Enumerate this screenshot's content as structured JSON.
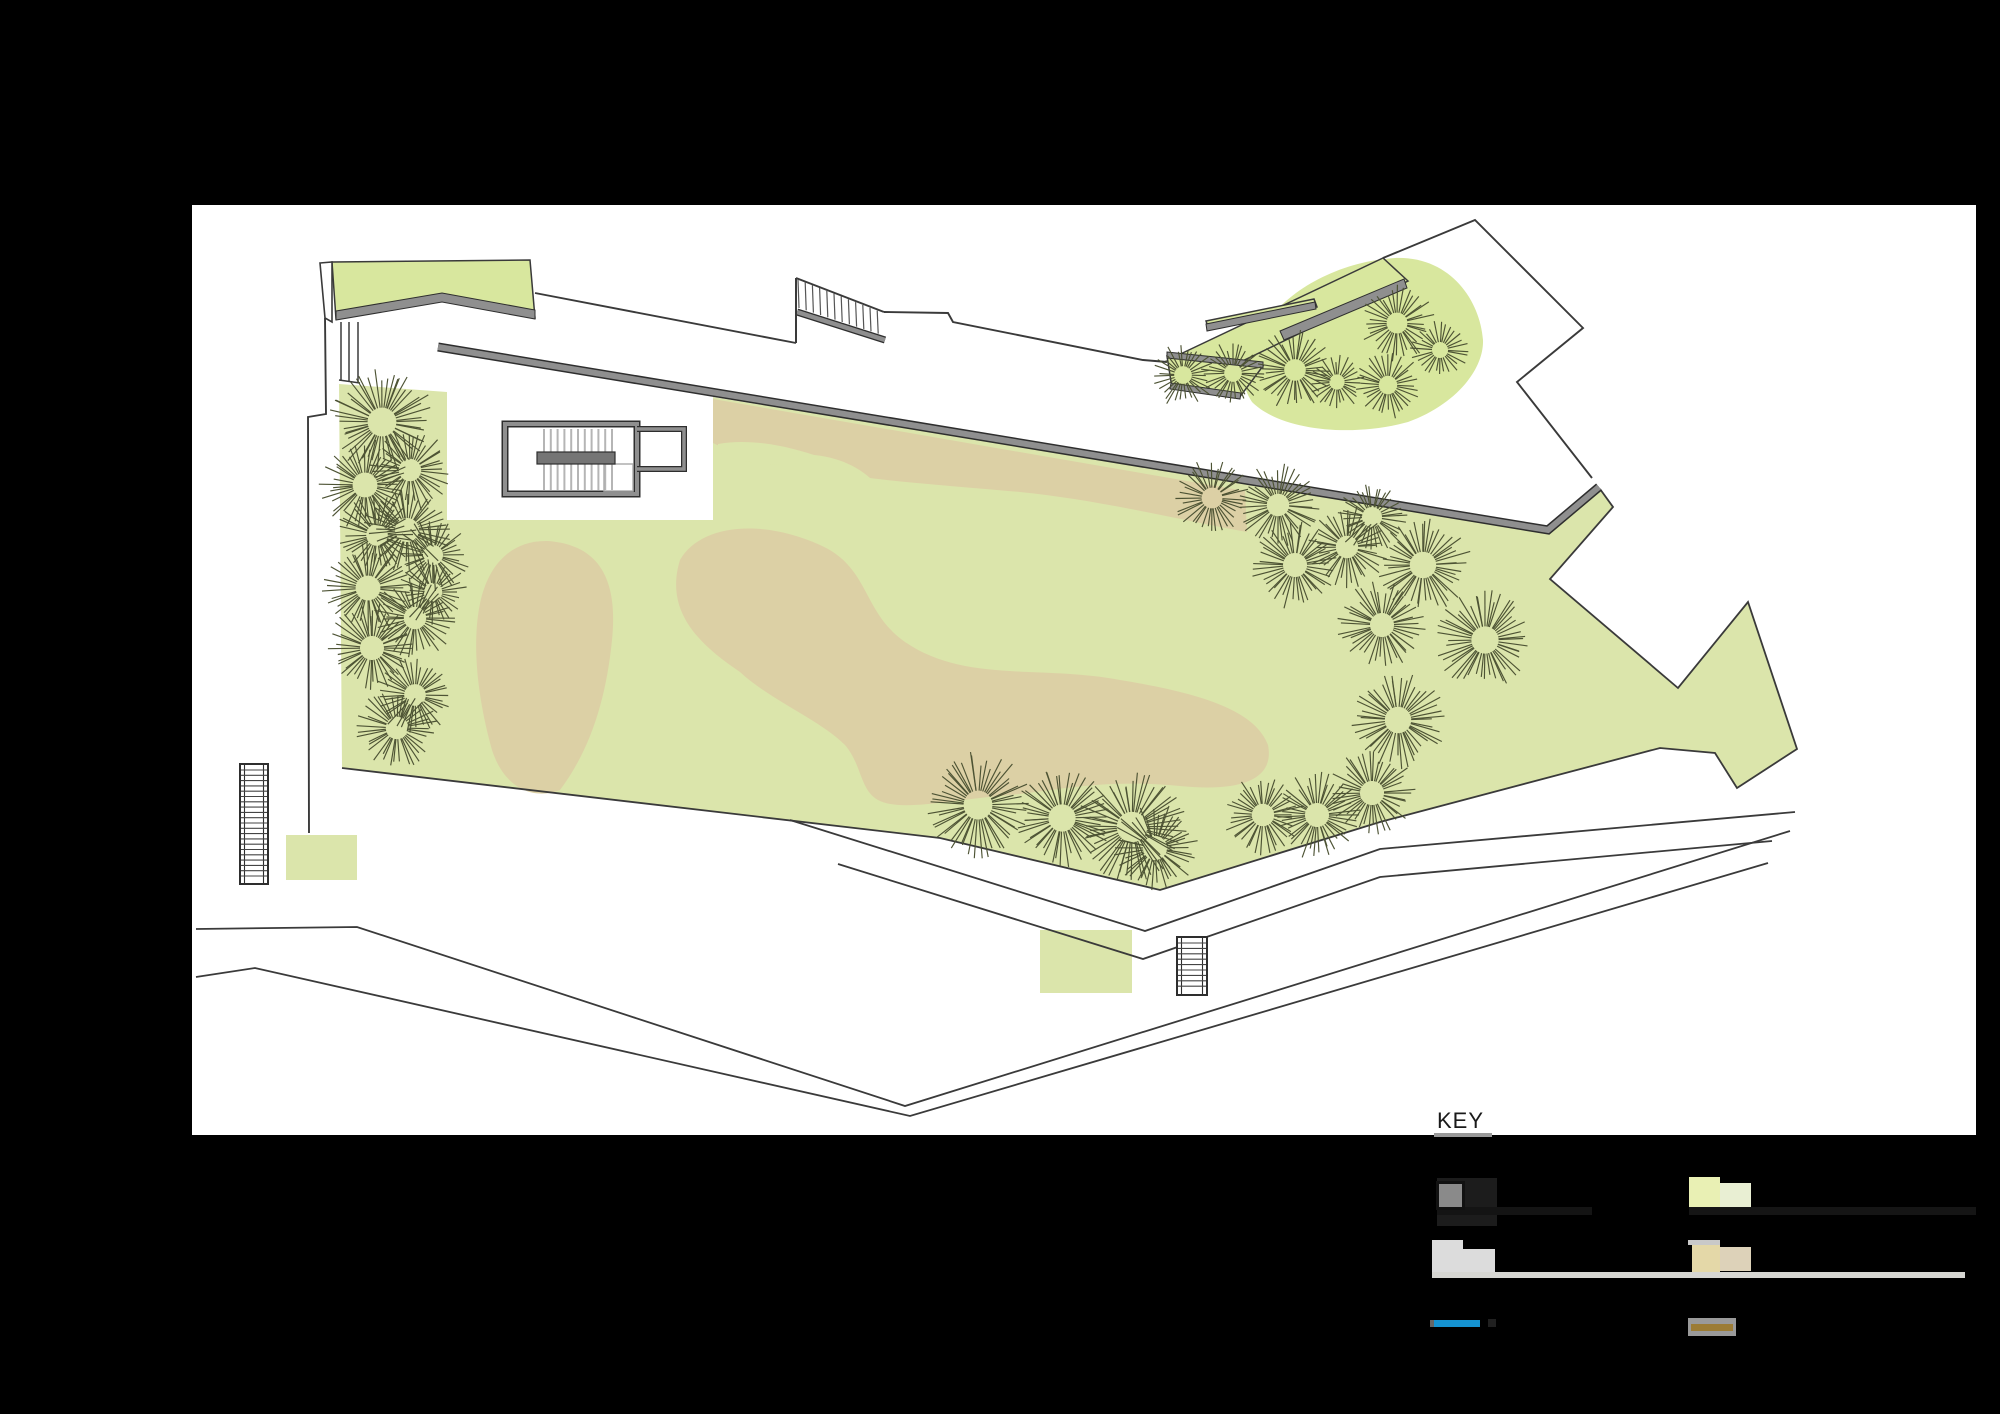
{
  "key": {
    "title": "KEY"
  },
  "legend": {
    "swatches": {
      "sw1": "#8a8a8a",
      "sw1_shadow": "#1c1c1c",
      "sw1_strip": "#141414",
      "sw2": "#e9f0b4",
      "sw2b": "#e9efd3",
      "sw2_strip": "#151515",
      "sw3": "#dcdcdc",
      "sw3b": "#dcdcdc",
      "strip_long": "#d6d6d2",
      "sw4": "#e4d8a8",
      "sw4b": "#ddd2b9",
      "sw4_sliver": "#c9c9c9",
      "sw5": "#1593d2",
      "sw5_tip": "#666666",
      "sw5_dot": "#202020",
      "sw6_bg": "#9a9a9a",
      "sw6": "#9c7c35"
    }
  },
  "plan": {
    "canvas": {
      "x": 192,
      "y": 205,
      "w": 1784,
      "h": 930,
      "fill": "#ffffff"
    },
    "colors": {
      "lawn": "#dbe5ab",
      "green2": "#d8e79e",
      "tan": "#dcd0a5",
      "wall": "#8f8f8f",
      "wallEdge": "#2e2e2e",
      "line": "#3a3a3a",
      "tree": "#4d5334",
      "tread": "#b5b5b5",
      "treadDark": "#555555",
      "landing": "#757575",
      "white": "#ffffff"
    },
    "lawn_path": "M339,384 L447,392 L447,520 L713,520 L713,397 L1548,532 L1600,489 L1613,507 L1550,579 L1678,688 L1748,602 L1797,749 L1737,788 L1715,753 L1660,748 L1380,822 L1160,890 L940,838 L342,768 Z",
    "lawn_outline": "M342,768 L940,838 L1160,890 L1380,822 L1660,748 L1715,753 L1737,788 L1797,749 L1748,602 L1678,688 L1550,579 L1613,507 L1600,489",
    "tan_shapes": [
      "M548,541 C600,545 618,580 612,640 C606,700 590,750 560,790 C535,800 505,790 492,750 C478,700 470,640 482,595 C492,560 515,540 548,541 Z",
      "M713,399 L1245,491 L1247,532 C1180,520 1100,500 1020,492 C950,486 900,482 870,478 C850,460 820,452 790,455 C760,458 730,452 713,443 Z",
      "M680,560 C700,525 760,518 820,545 C870,567 862,612 905,642 C965,683 1040,665 1120,680 C1200,693 1255,710 1268,745 C1275,780 1240,792 1180,786 C1100,778 1050,792 1000,796 C950,800 900,812 878,800 C860,790 862,765 845,745 C820,720 770,700 740,672 C700,645 664,612 680,560 Z"
    ],
    "green_shapes": [
      {
        "name": "canopy-roof",
        "path": "M332,262 L530,260 L535,318 L442,301 L336,319 Z",
        "fill": "green2",
        "stroke": true
      },
      {
        "name": "ne-blob",
        "path": "M1255,345 C1270,300 1330,262 1395,258 C1450,256 1480,300 1483,340 C1484,370 1455,405 1408,422 C1350,438 1280,430 1252,402 C1238,380 1242,362 1255,345 Z",
        "fill": "green2"
      },
      {
        "name": "ne-band-large",
        "path": "M1172,358 L1383,258 L1408,281 L1197,383 Z",
        "fill": "green2",
        "stroke": true
      },
      {
        "name": "ne-band-small",
        "path": "M1206,321 L1314,299 L1317,307 L1209,330 Z",
        "fill": "green2",
        "stroke": true
      },
      {
        "name": "ne-terrace",
        "path": "M1167,356 L1263,366 L1239,398 L1172,388 Z",
        "fill": "green2",
        "stroke": true
      },
      {
        "name": "south-lawn-rect",
        "path": "M1040,930 L1132,930 L1132,993 L1040,993 Z",
        "fill": "lawn"
      },
      {
        "name": "west-lawn-rect",
        "path": "M286,835 L357,835 L357,880 L286,880 Z",
        "fill": "lawn"
      },
      {
        "name": "green-tongue",
        "path": "M718,444 C750,438 790,446 822,458 C790,468 745,466 718,452 Z",
        "fill": "lawn"
      }
    ],
    "gray_strips": [
      {
        "name": "canopy-fascia",
        "path": "M336,311 L442,293 L535,310 L535,319 L442,302 L336,320 Z"
      },
      {
        "name": "ne-strip-large",
        "path": "M1280,331 L1404,279 L1407,288 L1284,340 Z"
      },
      {
        "name": "ne-strip-small",
        "path": "M1206,324 L1315,302 L1316,309 L1207,331 Z"
      },
      {
        "name": "ne-terrace-top",
        "path": "M1167,352 L1263,362 L1263,368 L1167,358 Z"
      },
      {
        "name": "ne-terrace-bottom",
        "path": "M1171,383 L1241,393 L1240,399 L1170,389 Z"
      }
    ],
    "walls": [
      {
        "name": "main-retaining-wall",
        "path": "M438,347 L1548,530 L1599,487",
        "outer": 9,
        "inner": 6
      },
      {
        "name": "top-stair-stringer",
        "path": "M797,312 L885,340",
        "outer": 7,
        "inner": 4.5
      }
    ],
    "outlines": [
      "M320,263 L332,262 L332,322 L325,318 Z",
      "M325,318 L326,414 L308,417 L309,833",
      "M535,293 L796,343",
      "M884,312 L948,313 L953,322 L1143,360 L1167,362",
      "M1383,258 L1475,220 L1583,328 L1517,382 L1592,478"
    ],
    "roads": [
      "M790,820 L1145,931 L1380,849 L1795,812",
      "M838,864 L1143,959 L1380,877 L1772,841",
      "M196,929 L357,927 L905,1106 L1790,831",
      "M196,977 L255,968 L910,1116 L1768,863"
    ],
    "stair_top": {
      "edgeL": [
        796,
        278,
        796,
        343
      ],
      "edgeT": [
        796,
        278,
        884,
        312
      ],
      "n": 12
    },
    "stair_nw": {
      "lines": [
        [
          341,
          322,
          341,
          381
        ],
        [
          349,
          322,
          349,
          381
        ],
        [
          358,
          322,
          358,
          382
        ]
      ],
      "base": [
        339,
        380,
        360,
        383
      ]
    },
    "stair_building": {
      "outer": [
        505,
        424,
        132,
        70
      ],
      "annex": "M637,429 L684,429 L684,469 L637,469",
      "treads": {
        "x0": 544,
        "dx": 6.8,
        "n": 11,
        "y0": 429,
        "y1": 490
      },
      "landing": [
        537,
        452,
        78,
        12
      ],
      "subrect": [
        604,
        464,
        29,
        27
      ]
    },
    "stair_w": {
      "rect": [
        240,
        764,
        28,
        120
      ],
      "rails": [
        244.5,
        263.5
      ],
      "treads": {
        "y0": 770,
        "dy": 5.3,
        "n": 21
      }
    },
    "stair_s": {
      "rect": [
        1177,
        937,
        30,
        58
      ],
      "rails": [
        1181.5,
        1202.5
      ],
      "treads": {
        "y0": 943,
        "dy": 5.4,
        "n": 9
      }
    },
    "trees": [
      [
        382,
        422,
        36
      ],
      [
        410,
        470,
        28
      ],
      [
        365,
        485,
        31
      ],
      [
        407,
        530,
        30
      ],
      [
        377,
        535,
        27
      ],
      [
        433,
        555,
        25
      ],
      [
        368,
        588,
        31
      ],
      [
        433,
        592,
        23
      ],
      [
        415,
        618,
        28
      ],
      [
        372,
        648,
        30
      ],
      [
        415,
        695,
        27
      ],
      [
        397,
        728,
        28
      ],
      [
        1183,
        375,
        22
      ],
      [
        1233,
        373,
        22
      ],
      [
        1295,
        370,
        27
      ],
      [
        1337,
        382,
        19
      ],
      [
        1388,
        385,
        23
      ],
      [
        1397,
        323,
        26
      ],
      [
        1440,
        350,
        20
      ],
      [
        1212,
        498,
        26
      ],
      [
        1278,
        505,
        28
      ],
      [
        1295,
        565,
        30
      ],
      [
        1347,
        547,
        28
      ],
      [
        1372,
        517,
        25
      ],
      [
        1423,
        565,
        33
      ],
      [
        1382,
        625,
        30
      ],
      [
        1485,
        640,
        34
      ],
      [
        1398,
        720,
        33
      ],
      [
        978,
        805,
        36
      ],
      [
        1062,
        818,
        34
      ],
      [
        1132,
        827,
        38
      ],
      [
        1155,
        848,
        30
      ],
      [
        1263,
        815,
        28
      ],
      [
        1317,
        815,
        30
      ],
      [
        1372,
        793,
        30
      ]
    ]
  }
}
